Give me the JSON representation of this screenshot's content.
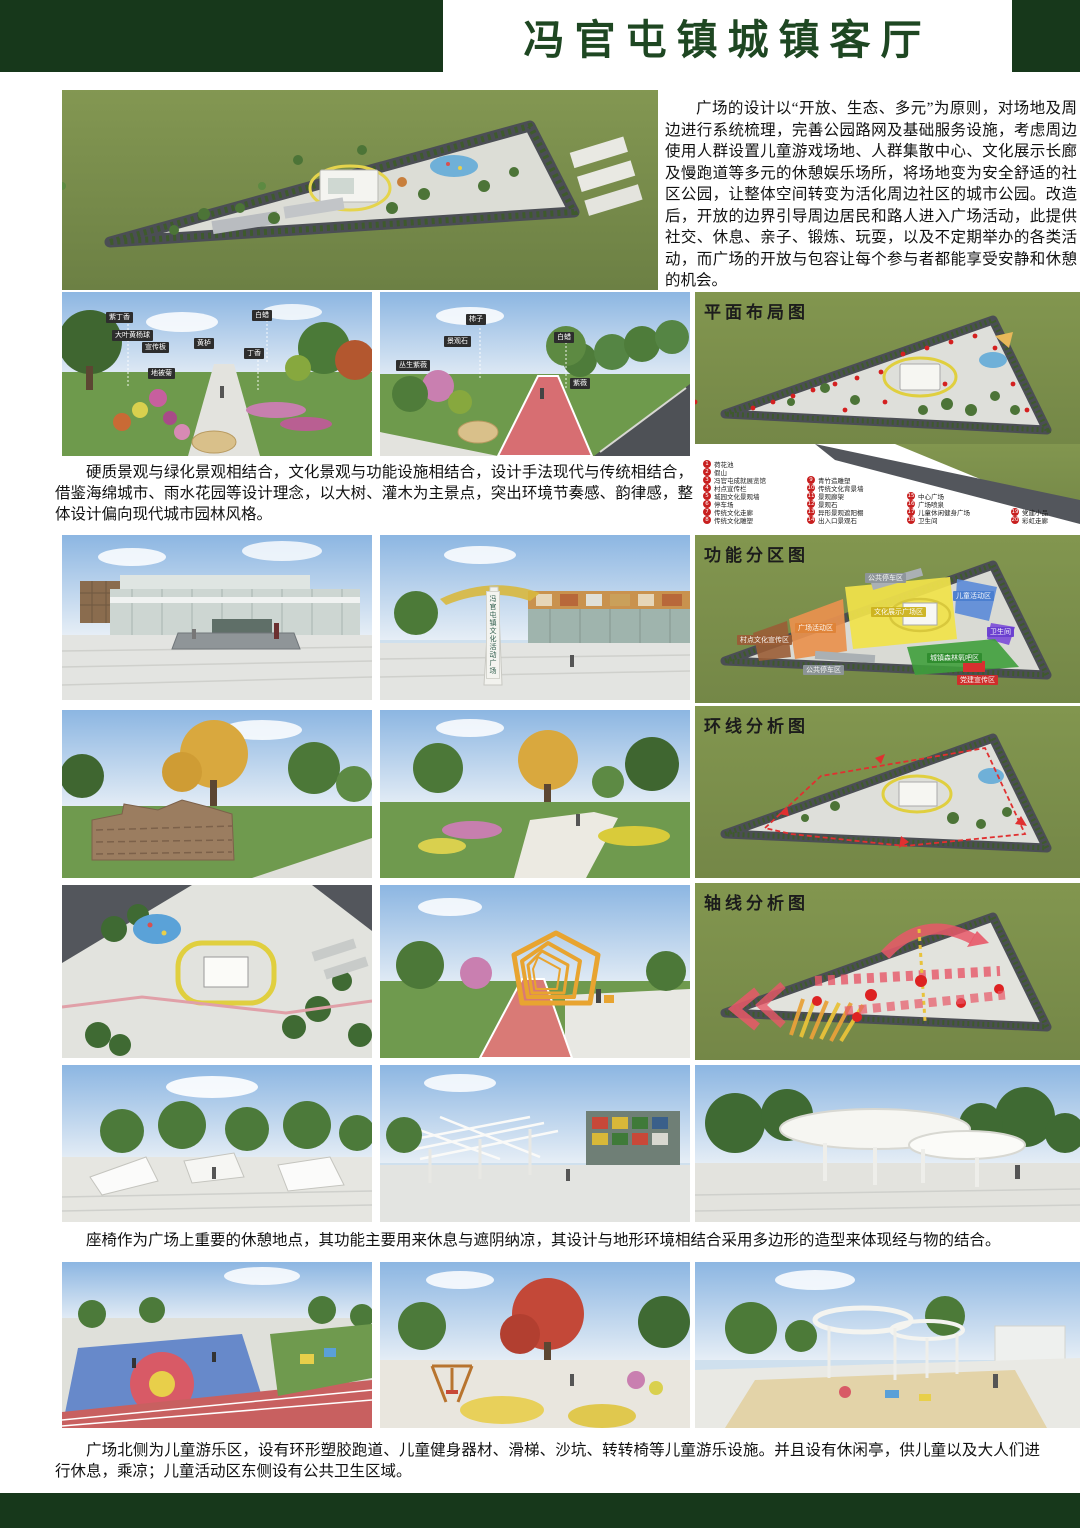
{
  "page": {
    "title": "冯官屯镇城镇客厅"
  },
  "intro": {
    "text": "广场的设计以“开放、生态、多元”为原则，对场地及周边进行系统梳理，完善公园路网及基础服务设施，考虑周边使用人群设置儿童游戏场地、人群集散中心、文化展示长廊及慢跑道等多元的休憩娱乐场所，将场地变为安全舒适的社区公园，让整体空间转变为活化周边社区的城市公园。改造后，开放的边界引导周边居民和路人进入广场活动，此提供社交、休息、亲子、锻炼、玩耍，以及不定期举办的各类活动，而广场的开放与包容让每个参与者都能享受安静和休憩的机会。"
  },
  "design_note": {
    "text": "硬质景观与绿化景观相结合，文化景观与功能设施相结合，设计手法现代与传统相结合，借鉴海绵城市、雨水花园等设计理念，以大树、灌木为主景点，突出环境节奏感、韵律感，整体设计偏向现代城市园林风格。"
  },
  "captions": {
    "seating": "座椅作为广场上重要的休憩地点，其功能主要用来休息与遮阴纳凉，其设计与地形环境相结合采用多边形的造型来体现经与物的结合。",
    "children": "广场北侧为儿童游乐区，设有环形塑胶跑道、儿童健身器材、滑梯、沙坑、转转椅等儿童游乐设施。并且设有休闲亭，供儿童以及大人们进行休息，乘凉；儿童活动区东侧设有公共卫生区域。"
  },
  "plans": {
    "layout": {
      "title": "平面布局图",
      "legend": {
        "items": [
          {
            "n": "1",
            "label": "荷花池"
          },
          {
            "n": "2",
            "label": "假山"
          },
          {
            "n": "3",
            "label": "冯官屯成就展览馆"
          },
          {
            "n": "4",
            "label": "村点宣传栏"
          },
          {
            "n": "5",
            "label": "城园文化景观墙"
          },
          {
            "n": "6",
            "label": "停车场"
          },
          {
            "n": "7",
            "label": "传统文化走廊"
          },
          {
            "n": "8",
            "label": "传统文化雕塑"
          },
          {
            "n": "9",
            "label": "青竹造雕塑"
          },
          {
            "n": "10",
            "label": "传统文化背景墙"
          },
          {
            "n": "11",
            "label": "景观廊架"
          },
          {
            "n": "12",
            "label": "景观石"
          },
          {
            "n": "13",
            "label": "异形景观遮阳棚"
          },
          {
            "n": "14",
            "label": "出入口景观石"
          },
          {
            "n": "15",
            "label": "中心广场"
          },
          {
            "n": "16",
            "label": "广场喷泉"
          },
          {
            "n": "17",
            "label": "儿童休闲健身广场"
          },
          {
            "n": "18",
            "label": "卫生间"
          },
          {
            "n": "19",
            "label": "党建小品"
          },
          {
            "n": "20",
            "label": "彩虹走廊"
          }
        ]
      }
    },
    "zoning": {
      "title": "功能分区图",
      "zones": [
        {
          "label": "公共停车区",
          "color": "#8e959b"
        },
        {
          "label": "儿童活动区",
          "color": "#4a7ed0"
        },
        {
          "label": "卫生间",
          "color": "#6a3fd0"
        },
        {
          "label": "文化展示广场区",
          "color": "#f0e24a"
        },
        {
          "label": "广场活动区",
          "color": "#e08438"
        },
        {
          "label": "村点文化宣传区",
          "color": "#9a5d36"
        },
        {
          "label": "城镇森林氧吧区",
          "color": "#2f8c2e"
        },
        {
          "label": "党建宣传区",
          "color": "#d42a2a"
        },
        {
          "label": "公共停车区",
          "color": "#8e959b"
        }
      ]
    },
    "loop": {
      "title": "环线分析图"
    },
    "axis": {
      "title": "轴线分析图"
    }
  },
  "renders": {
    "garden_labels": [
      "紫丁香",
      "大叶黄杨球",
      "宣传板",
      "地被菊",
      "黄栌",
      "白蜡",
      "丁香"
    ],
    "track_labels": [
      "柿子",
      "景观石",
      "丛生紫薇",
      "白蜡",
      "紫薇"
    ],
    "sign_vertical": "冯官屯镇文化活动广场"
  },
  "colors": {
    "banner_green": "#17381b",
    "title_green": "#1e4722",
    "legend_red": "#c81f1f",
    "plan_grass": "#7b8f4c"
  }
}
